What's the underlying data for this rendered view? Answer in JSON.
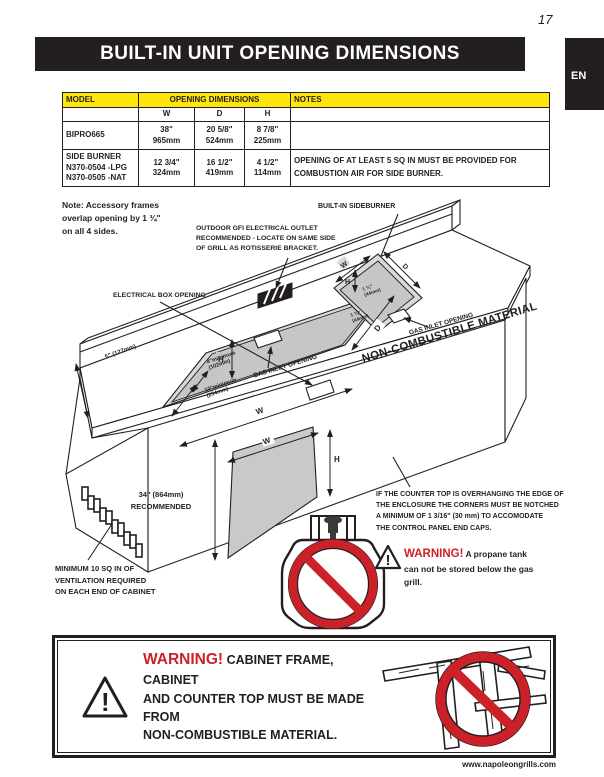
{
  "page": {
    "number": "17",
    "title": "BUILT-IN UNIT OPENING DIMENSIONS",
    "lang_tab": "EN",
    "url": "www.napoleongrills.com"
  },
  "table": {
    "headers": {
      "model": "MODEL",
      "opening": "OPENING DIMENSIONS",
      "notes": "NOTES"
    },
    "dims": {
      "w": "W",
      "d": "D",
      "h": "H"
    },
    "rows": [
      {
        "model": "BIPRO665",
        "model2": "",
        "model3": "",
        "w": "38\"",
        "w2": "965mm",
        "d": "20 5/8\"",
        "d2": "524mm",
        "h": "8 7/8\"",
        "h2": "225mm",
        "notes": ""
      },
      {
        "model": "SIDE BURNER",
        "model2": "N370-0504 -LPG",
        "model3": "N370-0505 -NAT",
        "w": "12 3/4\"",
        "w2": "324mm",
        "d": "16 1/2\"",
        "d2": "419mm",
        "h": "4 1/2\"",
        "h2": "114mm",
        "notes": "OPENING OF AT LEAST 5 SQ IN MUST BE PROVIDED FOR COMBUSTION AIR FOR SIDE BURNER."
      }
    ]
  },
  "note": {
    "line1": "Note: Accessory frames",
    "line2": "overlap opening by 1 ¾\"",
    "line3": "on all 4 sides."
  },
  "diagram": {
    "letters": {
      "w": "W",
      "d": "D",
      "h": "H"
    },
    "labels": {
      "gfi1": "OUTDOOR GFI ELECTRICAL OUTLET",
      "gfi2": "RECOMMENDED - LOCATE ON SAME SIDE",
      "gfi3": "OF GRILL AS ROTISSERIE BRACKET.",
      "sideburner": "BUILT-IN SIDEBURNER",
      "electrical": "ELECTRICAL BOX OPENING",
      "gas_inlet": "GAS INLET OPENING",
      "non_combustible": "NON-COMBUSTIBLE MATERIAL",
      "dim_5": "5\" (127mm)",
      "dim_4min_a": "4\"minimum",
      "dim_4min_b": "(102mm)",
      "dim_10min_a": "10\"minimum",
      "dim_10min_b": "(254mm)",
      "dim_134_a": "1 ¾\"",
      "dim_134_b": "(44mm)",
      "dim_34_a": "34\" (864mm)",
      "dim_34_b": "RECOMMENDED",
      "vent1": "MINIMUM 10 SQ IN OF",
      "vent2": "VENTILATION REQUIRED",
      "vent3": "ON EACH END OF CABINET",
      "overhang1": "IF THE COUNTER TOP IS OVERHANGING THE EDGE OF",
      "overhang2": "THE ENCLOSURE THE CORNERS MUST BE NOTCHED",
      "overhang3": "A MINIMUM OF 1 3/16\" (30 mm) TO ACCOMODATE",
      "overhang4": "THE CONTROL PANEL END CAPS.",
      "warning_title": "WARNING!",
      "warning1": "A propane tank",
      "warning2": "can not be stored below the gas",
      "warning3": "grill."
    }
  },
  "warning_box": {
    "title": "WARNING!",
    "line1": "CABINET FRAME, CABINET",
    "line2": "AND COUNTER TOP MUST BE MADE FROM",
    "line3": "NON-COMBUSTIBLE MATERIAL."
  },
  "colors": {
    "yellow": "#ffe60a",
    "red": "#cc2128",
    "bar": "#231f20"
  }
}
